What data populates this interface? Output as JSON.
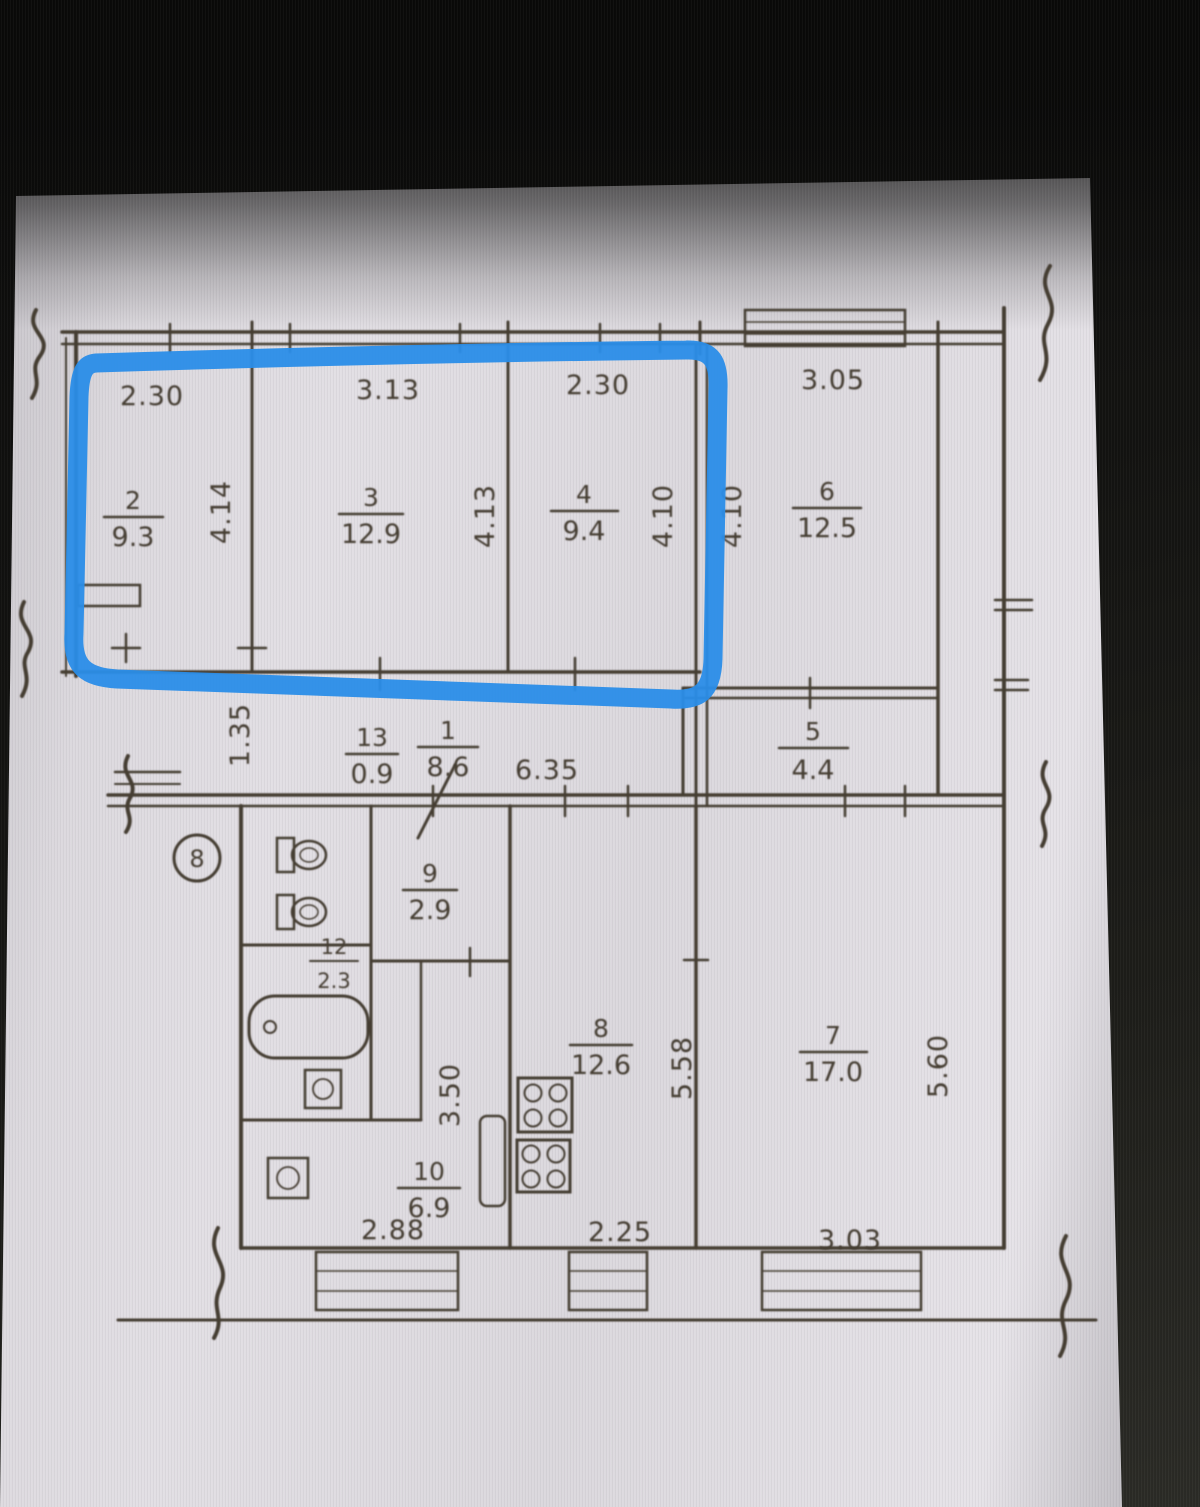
{
  "colors": {
    "highlight_blue": "#2a8de8",
    "ink": "#453c33",
    "paper": "#dedbe0",
    "screen_black": "#0c0c0b"
  },
  "rooms": {
    "r1": {
      "num": "1",
      "area": "8.6"
    },
    "r2": {
      "num": "2",
      "area": "9.3"
    },
    "r3": {
      "num": "3",
      "area": "12.9"
    },
    "r4": {
      "num": "4",
      "area": "9.4"
    },
    "r5": {
      "num": "5",
      "area": "4.4"
    },
    "r6": {
      "num": "6",
      "area": "12.5"
    },
    "r7": {
      "num": "7",
      "area": "17.0"
    },
    "r8": {
      "num": "8",
      "area": "12.6"
    },
    "r9": {
      "num": "9",
      "area": "2.9"
    },
    "r10": {
      "num": "10",
      "area": "6.9"
    },
    "r12": {
      "num": "12",
      "area": "2.3"
    },
    "r13": {
      "num": "13",
      "area": "0.9"
    }
  },
  "dimensions_top": {
    "room2_width": "2.30",
    "room3_width": "3.13",
    "room4_width": "2.30",
    "room6_width": "3.05"
  },
  "dimensions_vertical": {
    "room2_depth": "4.14",
    "room3_depth": "4.13",
    "room4_depth": "4.10",
    "room6_depth": "4.10",
    "hall_width": "1.35",
    "hall_length": "3.50",
    "room8_depth": "5.58",
    "room7_depth": "5.60"
  },
  "dimensions_middle": {
    "corridor_length": "6.35"
  },
  "dimensions_bottom": {
    "room10_width": "2.88",
    "room8_width": "2.25",
    "room7_width": "3.03"
  },
  "annotations": {
    "entrance_mark": "8"
  }
}
